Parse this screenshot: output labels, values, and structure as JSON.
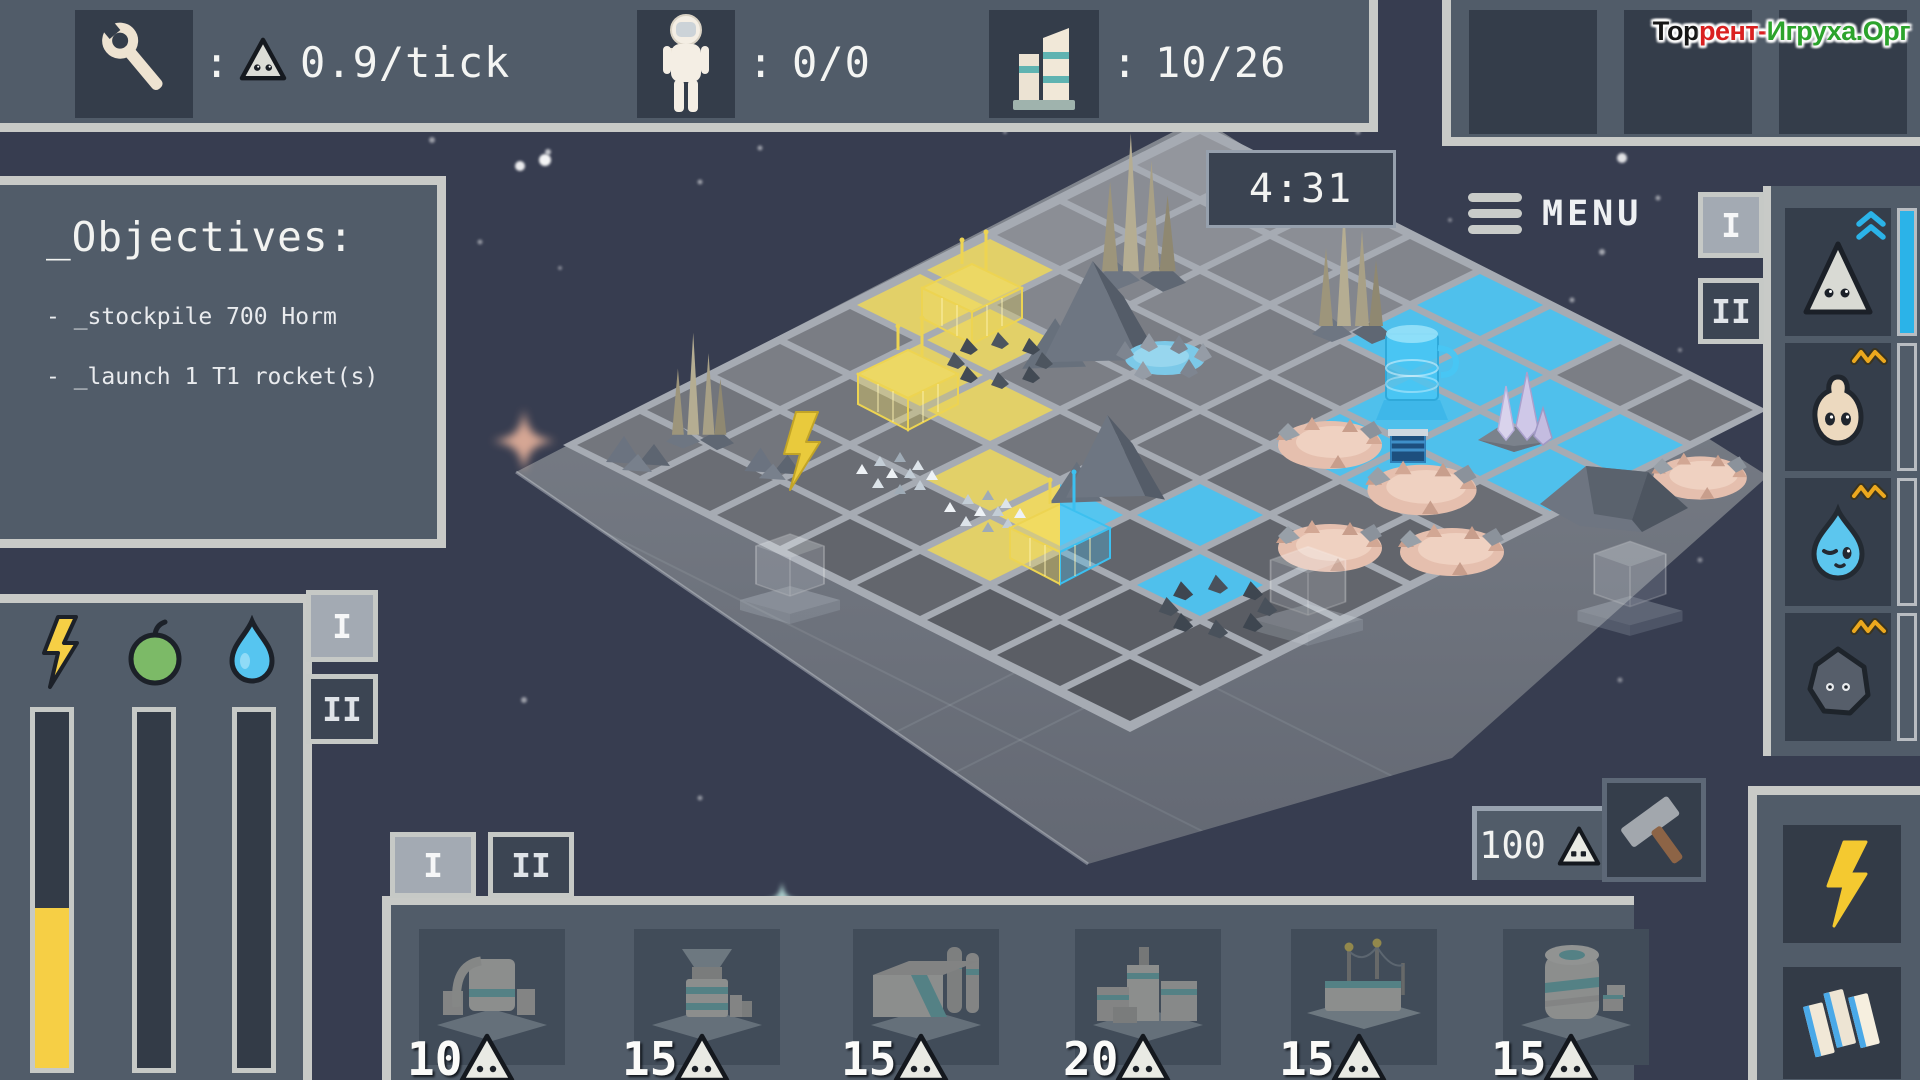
{
  "labels": {
    "colon": ":",
    "tab_i": "I",
    "tab_ii": "II"
  },
  "hud": {
    "wrench_stat_value": "0.9/tick",
    "colonists_value": "0/0",
    "buildings_value": "10/26",
    "timer": "4:31",
    "menu": "MENU",
    "watermark": [
      {
        "text": "Тор",
        "color": "#161616"
      },
      {
        "text": "рент-",
        "color": "#d92020"
      },
      {
        "text": "Игруха.Орг",
        "color": "#2ca32c"
      }
    ]
  },
  "objectives": {
    "title": "_Objectives:",
    "items": [
      "- _stockpile 700 Horm",
      "- _launch 1 T1 rocket(s)"
    ]
  },
  "resource_list": {
    "entries": [
      {
        "icon": "triangle-creature",
        "indicator": "double-chevron-up",
        "bar_fill": 1.0
      },
      {
        "icon": "blob-creature",
        "indicator": "orange-zigzag",
        "bar_fill": 0
      },
      {
        "icon": "droplet-creature",
        "indicator": "orange-zigzag",
        "bar_fill": 0
      },
      {
        "icon": "rock-creature",
        "indicator": "orange-zigzag",
        "bar_fill": 0
      }
    ]
  },
  "meters": {
    "bars": [
      {
        "icon": "bolt",
        "fill": 0.45,
        "color": "#f6cf45"
      },
      {
        "icon": "apple",
        "fill": 0,
        "color": "#7cba67"
      },
      {
        "icon": "droplet",
        "fill": 0,
        "color": "#56c5f0"
      }
    ]
  },
  "build_menu": {
    "cards": [
      {
        "cost": "10"
      },
      {
        "cost": "15"
      },
      {
        "cost": "15"
      },
      {
        "cost": "20"
      },
      {
        "cost": "15"
      },
      {
        "cost": "15"
      }
    ],
    "selection_cost": "100"
  },
  "colors": {
    "accent_cyan": "#2bb3e8",
    "accent_yellow": "#f6cf45",
    "tile_yellow": "#e2d068",
    "tile_cyan": "#4fc0ec",
    "panel": "#515c69",
    "panel_border": "#c8cac7",
    "slot": "#343d4a"
  },
  "board": {
    "grid": {
      "top_x": 1200,
      "top_y": 130,
      "tile_w": 140,
      "tile_h": 70,
      "cols": 8,
      "rows": 9,
      "yellow": [
        [
          0,
          3
        ],
        [
          0,
          4
        ],
        [
          1,
          4
        ],
        [
          1,
          5
        ],
        [
          2,
          5
        ],
        [
          3,
          6
        ],
        [
          4,
          7
        ]
      ],
      "cyan": [
        [
          4,
          0
        ],
        [
          5,
          0
        ],
        [
          4,
          1
        ],
        [
          5,
          1
        ],
        [
          6,
          1
        ],
        [
          7,
          1
        ],
        [
          5,
          2
        ],
        [
          6,
          2
        ],
        [
          7,
          2
        ],
        [
          5,
          3
        ],
        [
          6,
          3
        ],
        [
          5,
          5
        ],
        [
          6,
          6
        ]
      ],
      "construction": [
        4,
        6
      ]
    },
    "platform": [
      [
        1200,
        118
      ],
      [
        1768,
        476
      ],
      [
        1452,
        758
      ],
      [
        1088,
        864
      ],
      [
        516,
        472
      ]
    ],
    "features": [
      {
        "type": "sparkle",
        "x": 524,
        "y": 441,
        "c": "#f2b9a0",
        "s": 1.6
      },
      {
        "type": "sparkle",
        "x": 782,
        "y": 900,
        "c": "#bfe8e2",
        "s": 0.9
      },
      {
        "type": "spires",
        "x": 1140,
        "y": 262,
        "s": 1.15
      },
      {
        "type": "spires",
        "x": 1352,
        "y": 318,
        "s": 1.0
      },
      {
        "type": "spires",
        "x": 700,
        "y": 428,
        "s": 0.85
      },
      {
        "type": "pond",
        "x": 1165,
        "y": 358
      },
      {
        "type": "mountain",
        "x": 1108,
        "y": 338,
        "s": 1.1
      },
      {
        "type": "darkring",
        "x": 1000,
        "y": 360,
        "s": 1
      },
      {
        "type": "wf",
        "x": 972,
        "y": 300
      },
      {
        "type": "tower",
        "x": 1412,
        "y": 398
      },
      {
        "type": "crystals",
        "x": 1512,
        "y": 430
      },
      {
        "type": "crater",
        "x": 1330,
        "y": 445,
        "s": 1
      },
      {
        "type": "crater",
        "x": 1700,
        "y": 478,
        "s": 0.9
      },
      {
        "type": "rockedge",
        "x": 1612,
        "y": 492
      },
      {
        "type": "crater",
        "x": 1422,
        "y": 490,
        "s": 1.05
      },
      {
        "type": "miner",
        "x": 1408,
        "y": 462
      },
      {
        "type": "mountain",
        "x": 1120,
        "y": 478,
        "s": 0.9
      },
      {
        "type": "rocks",
        "x": 640,
        "y": 452,
        "s": 1
      },
      {
        "type": "rocks",
        "x": 775,
        "y": 462,
        "s": 0.9
      },
      {
        "type": "wf",
        "x": 908,
        "y": 386
      },
      {
        "type": "debris",
        "x": 900,
        "y": 476
      },
      {
        "type": "bolt3d",
        "x": 800,
        "y": 462
      },
      {
        "type": "crater",
        "x": 1330,
        "y": 548,
        "s": 1
      },
      {
        "type": "crater",
        "x": 1452,
        "y": 552,
        "s": 1
      },
      {
        "type": "debris",
        "x": 988,
        "y": 514
      },
      {
        "type": "construction",
        "x": 1060,
        "y": 540
      },
      {
        "type": "glass",
        "x": 790,
        "y": 586,
        "s": 1
      },
      {
        "type": "rubblering",
        "x": 1218,
        "y": 606
      },
      {
        "type": "glass",
        "x": 1308,
        "y": 604,
        "s": 1.1
      },
      {
        "type": "glass",
        "x": 1630,
        "y": 596,
        "s": 1.05
      }
    ],
    "stars": [
      [
        520,
        166,
        5,
        0.9
      ],
      [
        545,
        160,
        6,
        0.95
      ],
      [
        548,
        152,
        3,
        0.7
      ],
      [
        432,
        140,
        3,
        0.5
      ],
      [
        700,
        182,
        2.5,
        0.5
      ],
      [
        660,
        118,
        2,
        0.45
      ],
      [
        905,
        92,
        2.5,
        0.5
      ],
      [
        1005,
        132,
        2,
        0.4
      ],
      [
        760,
        148,
        2.5,
        0.5
      ],
      [
        480,
        242,
        2.5,
        0.45
      ],
      [
        560,
        268,
        2,
        0.4
      ],
      [
        418,
        320,
        2,
        0.4
      ],
      [
        388,
        500,
        2,
        0.4
      ],
      [
        342,
        622,
        2.5,
        0.45
      ],
      [
        524,
        700,
        3,
        0.5
      ],
      [
        700,
        798,
        2.5,
        0.45
      ],
      [
        870,
        948,
        3,
        0.5
      ],
      [
        958,
        1028,
        2.5,
        0.45
      ],
      [
        1118,
        688,
        2.5,
        0.4
      ],
      [
        1258,
        678,
        3,
        0.5
      ],
      [
        1310,
        718,
        2.5,
        0.45
      ],
      [
        1398,
        658,
        2,
        0.4
      ],
      [
        1498,
        640,
        3,
        0.5
      ],
      [
        1458,
        700,
        2.5,
        0.4
      ],
      [
        1572,
        300,
        2.5,
        0.5
      ],
      [
        1602,
        252,
        3,
        0.55
      ],
      [
        1658,
        198,
        2.5,
        0.5
      ],
      [
        1622,
        158,
        5,
        0.85
      ],
      [
        1680,
        350,
        2,
        0.4
      ],
      [
        1552,
        122,
        3,
        0.5
      ],
      [
        1358,
        132,
        2.5,
        0.45
      ],
      [
        1450,
        220,
        2,
        0.4
      ],
      [
        988,
        86,
        2,
        0.4
      ],
      [
        1228,
        100,
        2,
        0.4
      ],
      [
        1088,
        112,
        2.5,
        0.45
      ],
      [
        1700,
        560,
        2.5,
        0.4
      ],
      [
        1620,
        680,
        2.5,
        0.4
      ],
      [
        820,
        1020,
        2,
        0.4
      ],
      [
        1140,
        990,
        2,
        0.35
      ],
      [
        620,
        930,
        2,
        0.35
      ]
    ]
  }
}
